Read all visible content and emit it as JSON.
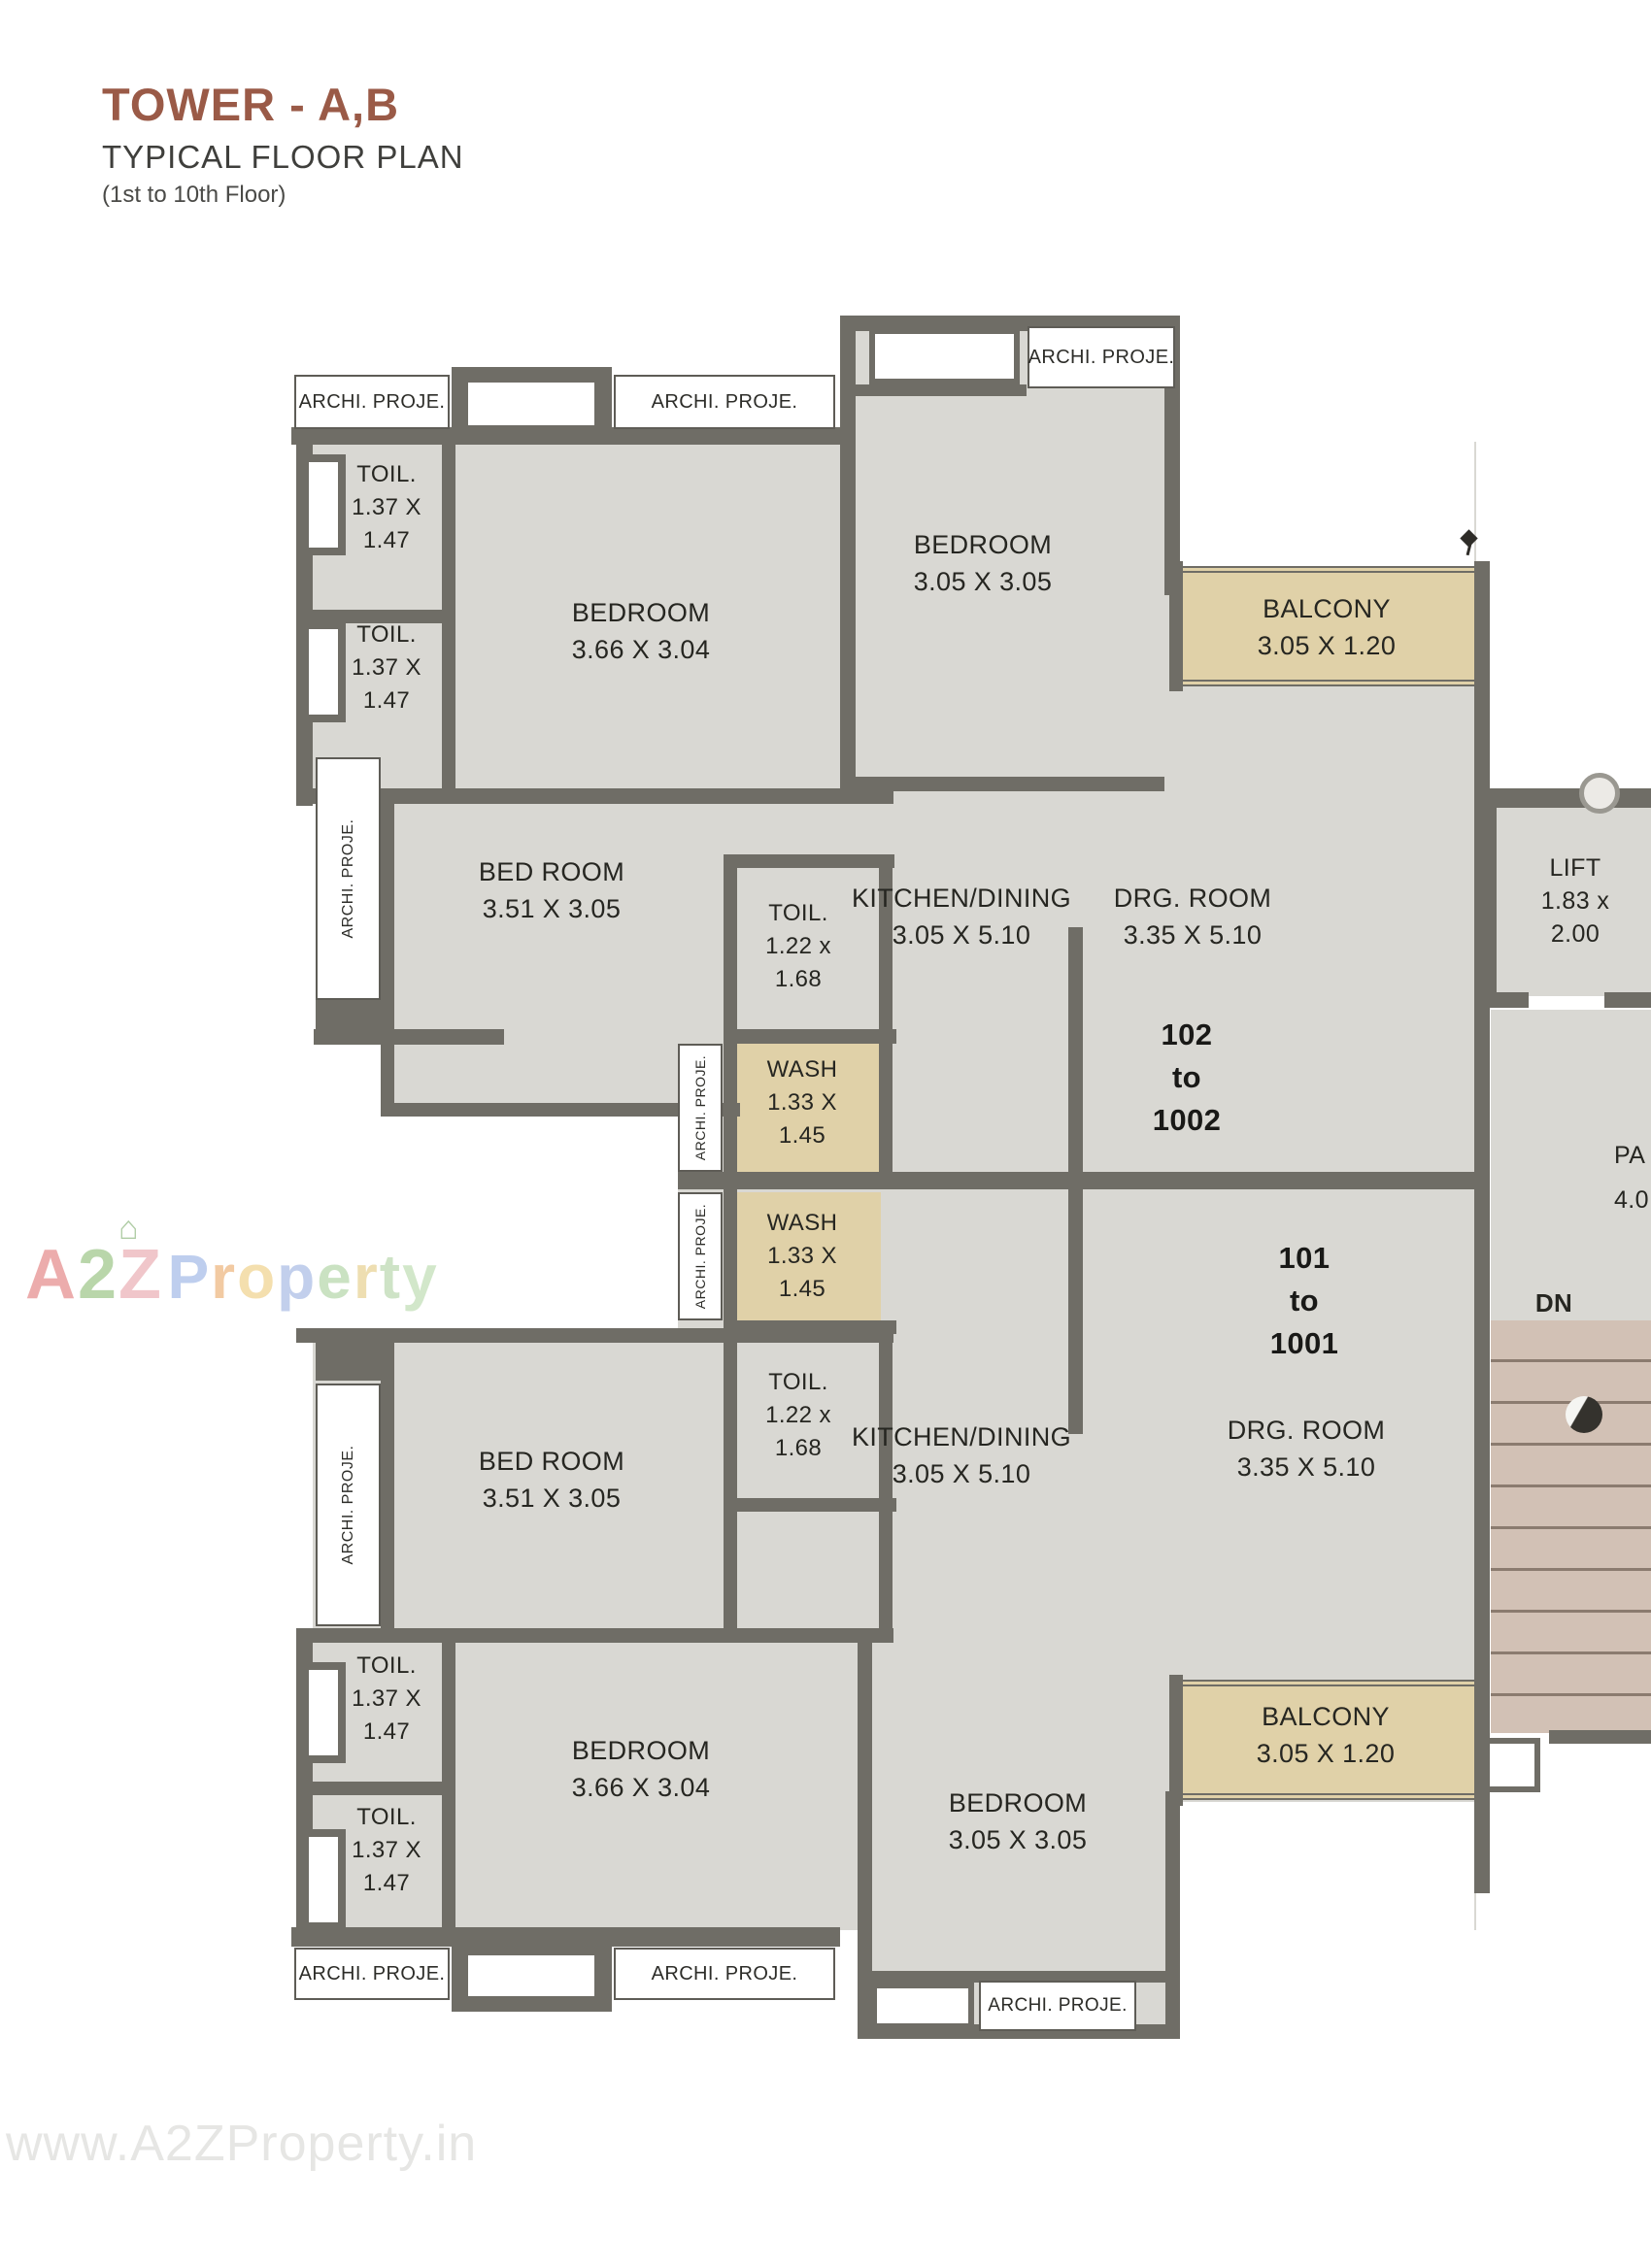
{
  "title": {
    "main": "TOWER - A,B",
    "sub": "TYPICAL FLOOR PLAN",
    "floors": "(1st to 10th Floor)"
  },
  "labels": {
    "archi": "ARCHI. PROJE.",
    "dn": "DN"
  },
  "rooms": {
    "toil_137": [
      "TOIL.",
      "1.37 X",
      "1.47"
    ],
    "toil_122": [
      "TOIL.",
      "1.22 x",
      "1.68"
    ],
    "wash": [
      "WASH",
      "1.33 X",
      "1.45"
    ],
    "bedroom_366": [
      "BEDROOM",
      "3.66 X 3.04"
    ],
    "bedroom_305": [
      "BEDROOM",
      "3.05 X 3.05"
    ],
    "bedroom_351": [
      "BED ROOM",
      "3.51 X 3.05"
    ],
    "kitchen": [
      "KITCHEN/DINING",
      "3.05 X 5.10"
    ],
    "drg": [
      "DRG. ROOM",
      "3.35 X 5.10"
    ],
    "balcony": [
      "BALCONY",
      "3.05 X 1.20"
    ],
    "lift": [
      "LIFT",
      "1.83 x",
      "2.00"
    ],
    "passage": [
      "PA",
      "4.0"
    ]
  },
  "units": {
    "upper": [
      "102",
      "to",
      "1002"
    ],
    "lower": [
      "101",
      "to",
      "1001"
    ]
  },
  "watermark": {
    "brand_letters": [
      {
        "c": "A",
        "color": "#e89898"
      },
      {
        "c": "2",
        "color": "#a8cc96"
      },
      {
        "c": "Z",
        "color": "#edb8bd"
      }
    ],
    "property_letters": [
      {
        "c": "P",
        "color": "#aec3ea"
      },
      {
        "c": "r",
        "color": "#f0bd8c"
      },
      {
        "c": "o",
        "color": "#f2d89b"
      },
      {
        "c": "p",
        "color": "#b3c4e8"
      },
      {
        "c": "e",
        "color": "#bedcb4"
      },
      {
        "c": "r",
        "color": "#ead79e"
      },
      {
        "c": "t",
        "color": "#c2ddb8"
      },
      {
        "c": "y",
        "color": "#c8e2bd"
      }
    ],
    "bottom": "www.A2ZProperty.in"
  },
  "colors": {
    "wall": "#6f6d66",
    "room": "#d9d8d3",
    "tan": "#e0d1a8",
    "stairs": "#d2c1b5",
    "title": "#9a5a47"
  }
}
